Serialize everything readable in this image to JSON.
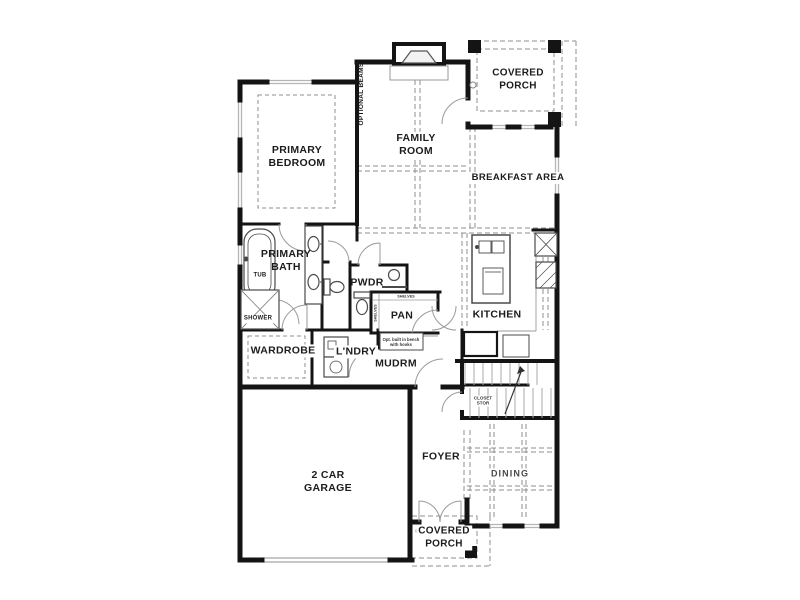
{
  "labels": {
    "primary_bedroom": "PRIMARY\nBEDROOM",
    "optional_beams": "OPTIONAL BEAMS",
    "family_room": "FAMILY\nROOM",
    "covered_porch_upper": "COVERED\nPORCH",
    "breakfast_area": "BREAKFAST AREA",
    "primary_bath": "PRIMARY\nBATH",
    "tub": "TUB",
    "shower": "SHOWER",
    "powder": "PWDR",
    "pantry": "PAN",
    "shelves": "SHELVES",
    "kitchen": "KITCHEN",
    "wardrobe": "WARDROBE",
    "laundry": "L'NDRY",
    "mudroom": "MUDRM",
    "bench_note": "Opt. built in bench\nwith hooks",
    "stair_closet": "CLOSET\nSTOR",
    "garage": "2 CAR\nGARAGE",
    "foyer": "FOYER",
    "dining": "DINING",
    "covered_porch_lower": "COVERED\nPORCH"
  },
  "colors": {
    "wall": "#141414",
    "dash": "#8f8f8f",
    "window": "#b5b5b5",
    "fixture": "#4a4a4a",
    "text": "#1c1c1c",
    "background": "#ffffff"
  }
}
